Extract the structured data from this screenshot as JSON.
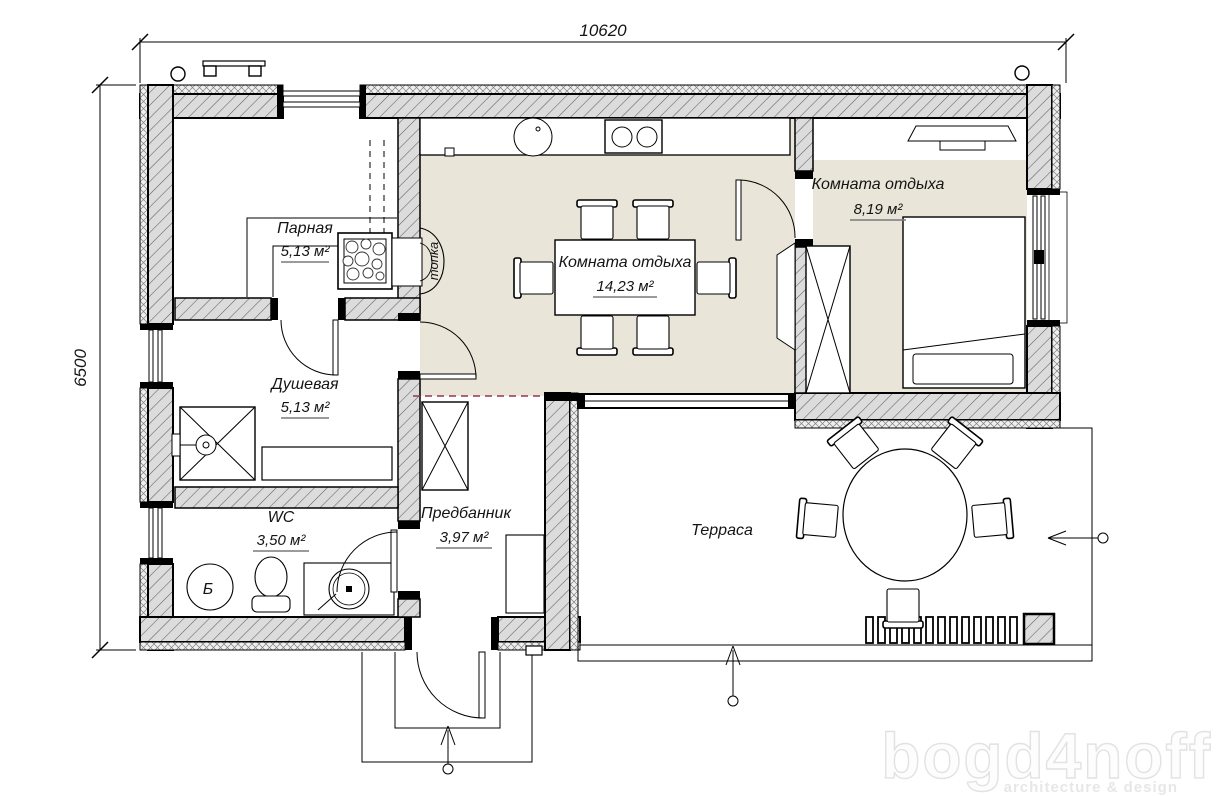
{
  "title": "Bath house floor plan",
  "dimensions": {
    "top": "10620",
    "left": "6500"
  },
  "rooms": [
    {
      "id": "parnaya",
      "name": "Парная",
      "area": "5,13 м²"
    },
    {
      "id": "dushevaya",
      "name": "Душевая",
      "area": "5,13 м²"
    },
    {
      "id": "wc",
      "name": "WC",
      "area": "3,50 м²"
    },
    {
      "id": "predbannik",
      "name": "Предбанник",
      "area": "3,97 м²"
    },
    {
      "id": "lounge",
      "name": "Комната отдыха",
      "area": "14,23 м²"
    },
    {
      "id": "lounge2",
      "name": "Комната отдыха",
      "area": "8,19 м²"
    },
    {
      "id": "terrace",
      "name": "Терраса",
      "area": ""
    }
  ],
  "labels": {
    "furnace": "топка",
    "boiler": "Б"
  },
  "watermark": {
    "brand": "bogd4noff",
    "tagline": "architecture & design"
  },
  "colors": {
    "floor": "#eae5d9",
    "wall_fill": "#dcdcdc",
    "opening_dashed": "#993355",
    "watermark": "#e2e2e2"
  }
}
